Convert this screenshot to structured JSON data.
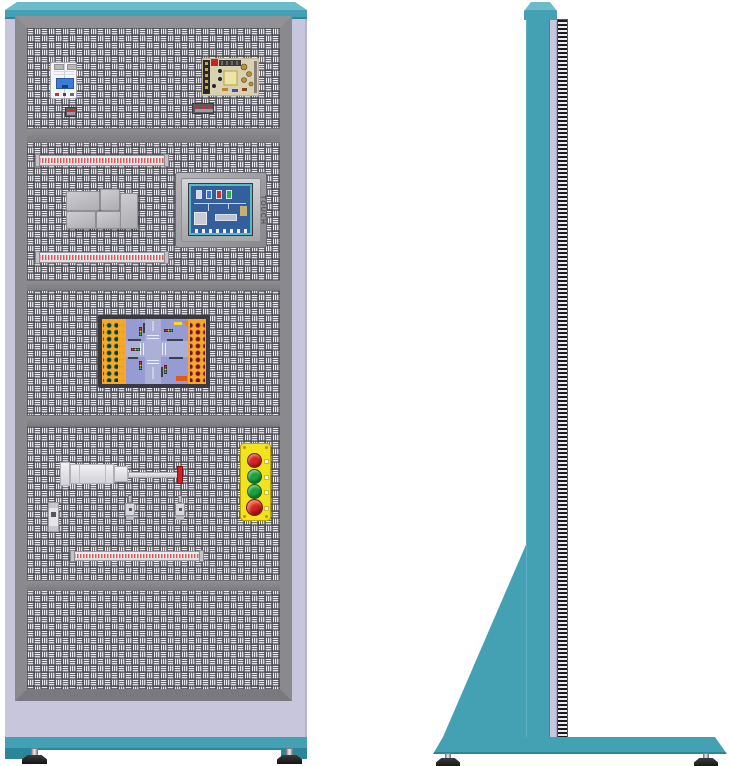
{
  "hmi": {
    "side_label": "TOUCH"
  },
  "push_button_station": {
    "panel_color": "#f2e41c",
    "buttons": [
      {
        "name": "red-pushbutton",
        "color": "#d42424"
      },
      {
        "name": "green-pushbutton",
        "color": "#1ba13d"
      },
      {
        "name": "green-pushbutton-2",
        "color": "#1ba13d"
      },
      {
        "name": "emergency-stop",
        "color": "#d42424"
      }
    ]
  },
  "colors": {
    "frame_teal": "#44a0b3",
    "teal_light": "#6abccb",
    "teal_dark": "#2c8598",
    "cabinet_lavender": "#c7c6dc",
    "panel_gray": "#8b8b8b",
    "perforation_dark": "#47474d",
    "perforation_light": "#e9e9f1",
    "terminal_red": "#d65a5a",
    "button_panel_yellow": "#f2e41c",
    "board_orange": "#f5a82a",
    "board_blue": "#969bd3",
    "hmi_screen_blue": "#335f9c",
    "hmi_screen_teal": "#53bccb",
    "cylinder_red_tip": "#cc2424"
  }
}
